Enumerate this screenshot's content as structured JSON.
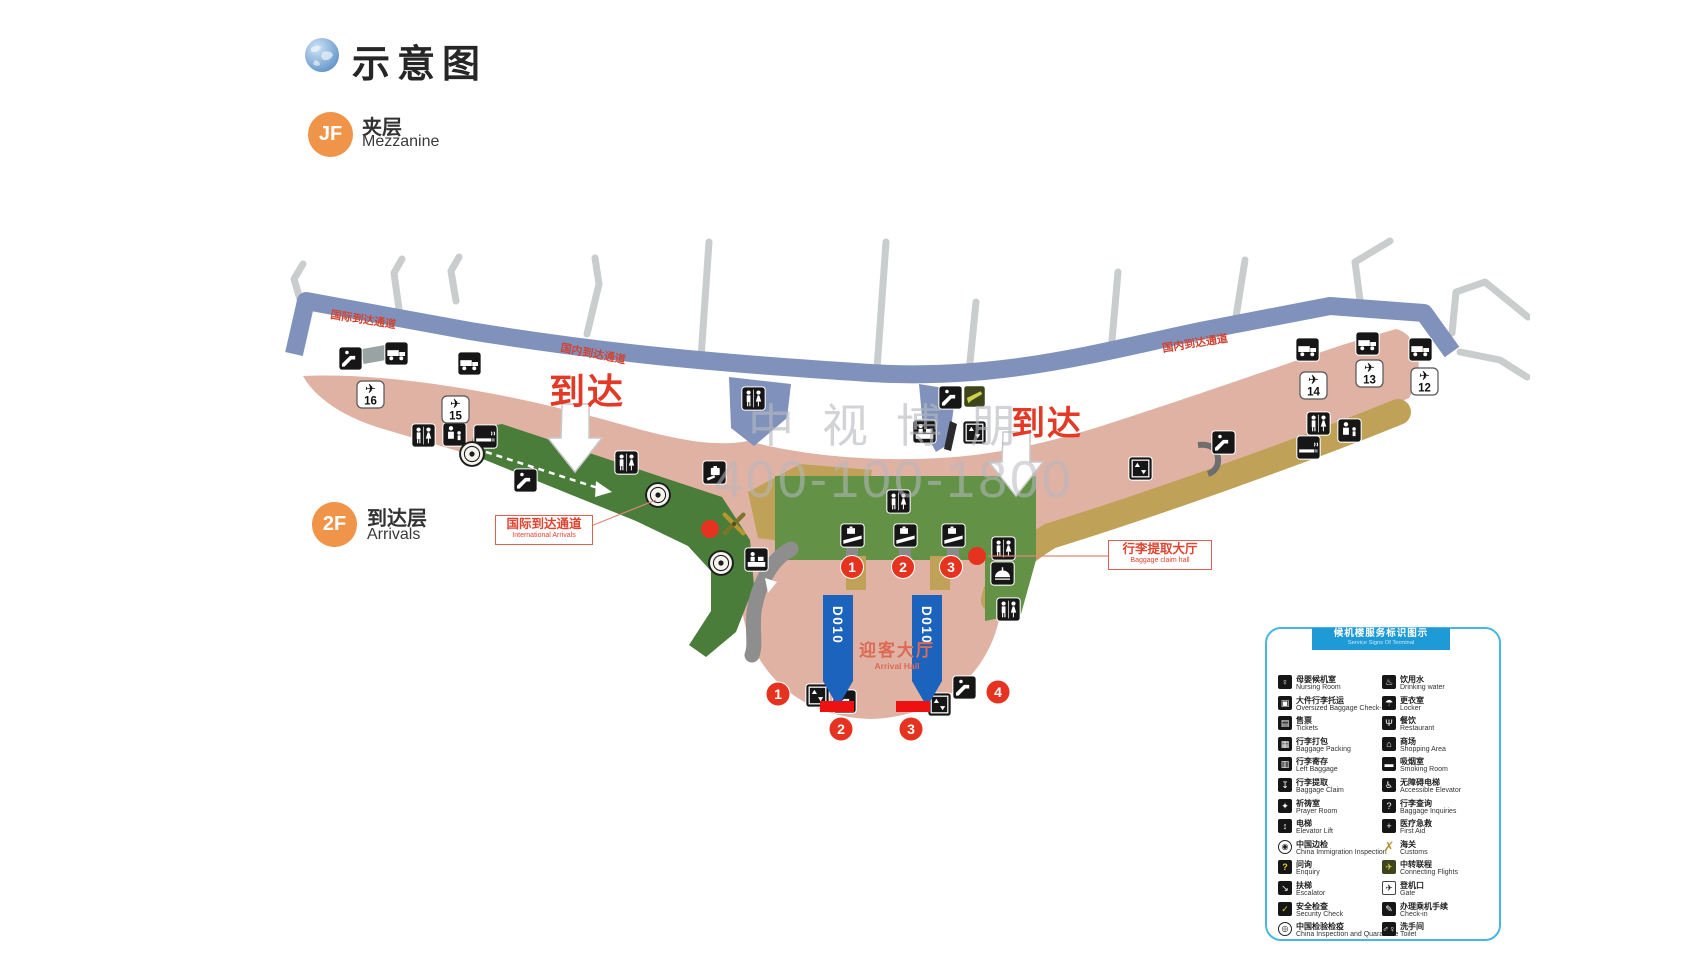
{
  "title": {
    "text": "示意图"
  },
  "floors": {
    "mezzanine": {
      "badge": "JF",
      "zh": "夹层",
      "en": "Mezzanine"
    },
    "arrivals": {
      "badge": "2F",
      "zh": "到达层",
      "en": "Arrivals"
    }
  },
  "watermark": {
    "line1": "中视博朋",
    "line2": "400-100-1800"
  },
  "icons": {
    "globe": "blue-globe",
    "plane": "✈",
    "toilet": "♂♀",
    "escalator": "diagonal-steps",
    "elevator": "↕",
    "baggage_cart": "truck-shape",
    "smoking": "cigarette-bar",
    "nursing": "parent-child",
    "baggage_claim": "hand-with-case",
    "carousel": "case-on-belt",
    "customs": "crossed-tools",
    "inspection_stamp": "round-seal",
    "check_in": "desk-clerk",
    "locker": "hanger-dome",
    "connecting": "lime-plane"
  },
  "map": {
    "arrival": "到达",
    "d010": "D010",
    "gates": [
      "16",
      "15",
      "14",
      "13",
      "12"
    ],
    "carousels": [
      "1",
      "2",
      "3"
    ],
    "doors": [
      "1",
      "2",
      "3",
      "4"
    ],
    "corridor_labels": {
      "international": "国际到达通道",
      "domestic_left": "国内到达通道",
      "domestic_right": "国内到达通道"
    },
    "labels": {
      "international_box": {
        "zh": "国际到达通道",
        "en": "International Arrivals"
      },
      "baggage_box": {
        "zh": "行李提取大厅",
        "en": "Baggage claim hall"
      },
      "arrival_hall": {
        "zh": "迎客大厅",
        "en": "Arrival Hall"
      }
    },
    "accent_colors": {
      "terminal_pink": "#dfb2a4",
      "corridor_blue": "#8092bb",
      "walkway_green": "#4a7c3a",
      "hall_green": "#639247",
      "khaki": "#bfa257",
      "marker_red": "#e6331f",
      "d010_blue": "#1c63bd"
    }
  },
  "legend": {
    "header": {
      "zh": "候机楼服务标识图示",
      "en": "Service Signs Of Terminal"
    },
    "left": [
      {
        "icon": "nursing-room-icon",
        "glyph": "♀",
        "variant": "dark",
        "zh": "母婴候机室",
        "en": "Nursing Room"
      },
      {
        "icon": "oversized-baggage-icon",
        "glyph": "▣",
        "variant": "dark",
        "zh": "大件行李托运",
        "en": "Oversized Baggage Check-in"
      },
      {
        "icon": "tickets-icon",
        "glyph": "▤",
        "variant": "dark",
        "zh": "售票",
        "en": "Tickets"
      },
      {
        "icon": "baggage-packing-icon",
        "glyph": "▦",
        "variant": "dark",
        "zh": "行李打包",
        "en": "Baggage Packing"
      },
      {
        "icon": "left-baggage-icon",
        "glyph": "▥",
        "variant": "dark",
        "zh": "行李寄存",
        "en": "Left Baggage"
      },
      {
        "icon": "baggage-claim-icon",
        "glyph": "↧",
        "variant": "dark",
        "zh": "行李提取",
        "en": "Baggage Claim"
      },
      {
        "icon": "prayer-room-icon",
        "glyph": "✦",
        "variant": "dark",
        "zh": "祈祷室",
        "en": "Prayer Room"
      },
      {
        "icon": "elevator-icon",
        "glyph": "↕",
        "variant": "dark",
        "zh": "电梯",
        "en": "Elevator Lift"
      },
      {
        "icon": "china-immigration-icon",
        "glyph": "◉",
        "variant": "stamp",
        "zh": "中国边检",
        "en": "China Immigration Inspection"
      },
      {
        "icon": "enquiry-icon",
        "glyph": "?",
        "variant": "yellow",
        "zh": "问询",
        "en": "Enquiry"
      },
      {
        "icon": "escalator-icon",
        "glyph": "↘",
        "variant": "dark",
        "zh": "扶梯",
        "en": "Escalator"
      },
      {
        "icon": "security-check-icon",
        "glyph": "✓",
        "variant": "yellow",
        "zh": "安全检查",
        "en": "Security Check"
      },
      {
        "icon": "china-inspection-icon",
        "glyph": "◎",
        "variant": "stamp",
        "zh": "中国检验检疫",
        "en": "China Inspection and Quarantine"
      }
    ],
    "right": [
      {
        "icon": "drinking-water-icon",
        "glyph": "♨",
        "variant": "dark",
        "zh": "饮用水",
        "en": "Drinking water"
      },
      {
        "icon": "locker-icon",
        "glyph": "☂",
        "variant": "dark",
        "zh": "更衣室",
        "en": "Locker"
      },
      {
        "icon": "restaurant-icon",
        "glyph": "Ψ",
        "variant": "dark",
        "zh": "餐饮",
        "en": "Restaurant"
      },
      {
        "icon": "shopping-area-icon",
        "glyph": "⌂",
        "variant": "dark",
        "zh": "商场",
        "en": "Shopping Area"
      },
      {
        "icon": "smoking-room-icon",
        "glyph": "▬",
        "variant": "dark",
        "zh": "吸烟室",
        "en": "Smoking Room"
      },
      {
        "icon": "accessible-elevator-icon",
        "glyph": "♿",
        "variant": "dark",
        "zh": "无障碍电梯",
        "en": "Accessible Elevator"
      },
      {
        "icon": "baggage-inquiries-icon",
        "glyph": "?",
        "variant": "dark",
        "zh": "行李查询",
        "en": "Baggage Inquiries"
      },
      {
        "icon": "first-aid-icon",
        "glyph": "+",
        "variant": "dark",
        "zh": "医疗急救",
        "en": "First Aid"
      },
      {
        "icon": "customs-icon",
        "glyph": "✗",
        "variant": "gold",
        "zh": "海关",
        "en": "Customs"
      },
      {
        "icon": "connecting-flights-icon",
        "glyph": "✈",
        "variant": "lime",
        "zh": "中转联程",
        "en": "Connecting Flights"
      },
      {
        "icon": "gate-icon",
        "glyph": "✈",
        "variant": "light",
        "zh": "登机口",
        "en": "Gate"
      },
      {
        "icon": "check-in-icon",
        "glyph": "✎",
        "variant": "dark",
        "zh": "办理乘机手续",
        "en": "Check-in"
      },
      {
        "icon": "toilet-icon",
        "glyph": "♂♀",
        "variant": "dark",
        "zh": "洗手间",
        "en": "Toilet"
      }
    ]
  }
}
